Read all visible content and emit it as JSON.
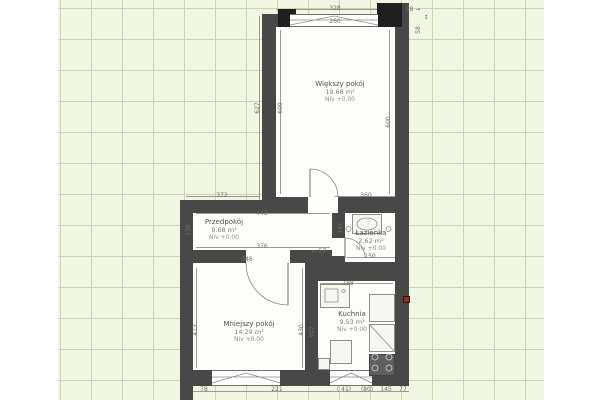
{
  "app": {
    "view": "floor-plan-editor-canvas"
  },
  "palette": {
    "canvas_bg": "#f1f6e3",
    "grid_line": "#ccd5a9",
    "page_margin": "#ffffff",
    "wall": "#484848",
    "corner_block": "#1f1f1f",
    "floor": "#fdfdf9",
    "dimension": "#6f6f6a",
    "marker_red": "#8a3228"
  },
  "rooms": [
    {
      "key": "wiekszy-pokoj",
      "name": "Większy pokój",
      "area": "19.68 m²",
      "level": "Niv +0.00",
      "floor": [
        276,
        27,
        119,
        170
      ],
      "label": [
        340,
        80
      ]
    },
    {
      "key": "przedpokoj",
      "name": "Przedpokój",
      "area": "9.68 m²",
      "level": "Niv +0.00",
      "floor": [
        193,
        213,
        139,
        37
      ],
      "label": [
        224,
        218
      ]
    },
    {
      "key": "lazienka",
      "name": "Łazienka",
      "area": "2.62 m²",
      "level": "Niv +0.00",
      "floor": [
        345,
        213,
        50,
        49
      ],
      "label": [
        371,
        229
      ]
    },
    {
      "key": "mniejszy-pokoj",
      "name": "Mniejszy pokój",
      "area": "14.29 m²",
      "level": "Niv +0.00",
      "floor": [
        193,
        263,
        112,
        107
      ],
      "label": [
        249,
        320
      ]
    },
    {
      "key": "kuchnia",
      "name": "Kuchnia",
      "area": "9.53 m²",
      "level": "Niv +0.00",
      "floor": [
        318,
        281,
        77,
        89
      ],
      "label": [
        352,
        310
      ]
    }
  ],
  "walls": [
    [
      262,
      14,
      147,
      13
    ],
    [
      262,
      14,
      14,
      196
    ],
    [
      395,
      3,
      14,
      383
    ],
    [
      276,
      197,
      119,
      16
    ],
    [
      180,
      200,
      96,
      13
    ],
    [
      180,
      200,
      13,
      200
    ],
    [
      332,
      213,
      13,
      25
    ],
    [
      332,
      256,
      13,
      12
    ],
    [
      318,
      262,
      91,
      19
    ],
    [
      180,
      250,
      152,
      13
    ],
    [
      305,
      263,
      13,
      123
    ],
    [
      180,
      370,
      229,
      16
    ]
  ],
  "corner_blocks": [
    [
      278,
      9,
      18,
      18
    ],
    [
      377,
      3,
      25,
      24
    ]
  ],
  "door_gaps": [
    [
      308,
      197,
      30,
      16
    ],
    [
      246,
      250,
      44,
      13
    ],
    [
      332,
      238,
      13,
      18
    ]
  ],
  "windows": [
    {
      "rect": [
        290,
        14,
        88,
        13
      ],
      "path": "M290,20 L378,20 M290,25 L334,16 L378,25"
    },
    {
      "rect": [
        212,
        370,
        68,
        16
      ],
      "path": "M212,377 L280,377 M212,383 L246,373 L280,383"
    },
    {
      "rect": [
        330,
        370,
        42,
        16
      ],
      "path": "M330,377 L372,377 M330,383 L351,373 L372,383"
    }
  ],
  "doors": [
    {
      "name": "door-wiekszy-pokoj",
      "arc": "M338,197 A28,28 0 0 0 310,169",
      "leaf": "M310,197 L310,169"
    },
    {
      "name": "door-mniejszy-pokoj",
      "arc": "M246,263 A42,42 0 0 0 288,305",
      "leaf": "M288,263 L288,305"
    },
    {
      "name": "door-lazienka",
      "arc": "M345,238 A20,20 0 0 1 365,258",
      "leaf": "M345,258 L345,238"
    }
  ],
  "fixtures": [
    {
      "name": "bath-sink",
      "rect": [
        352,
        214,
        30,
        20
      ],
      "dark": false
    },
    {
      "name": "kitchen-sink",
      "rect": [
        320,
        284,
        30,
        24
      ],
      "dark": false
    },
    {
      "name": "kitchen-counter",
      "rect": [
        369,
        294,
        26,
        28
      ],
      "dark": false
    },
    {
      "name": "kitchen-counter",
      "rect": [
        369,
        324,
        26,
        28
      ],
      "dark": false
    },
    {
      "name": "kitchen-stove",
      "rect": [
        369,
        354,
        26,
        22
      ],
      "dark": true
    },
    {
      "name": "kitchen-cabinet",
      "rect": [
        330,
        340,
        22,
        24
      ],
      "dark": false
    },
    {
      "name": "kitchen-cabinet",
      "rect": [
        318,
        358,
        12,
        12
      ],
      "dark": false
    }
  ],
  "fixture_detail_path": "M357,224 a10,6 0 1 0 20,0 a10,6 0 1 0 -20,0 M325,289 h13 v13 h-13 z M342,291 a1.5,1.5 0 1 0 3,0 a1.5,1.5 0 1 0 -3,0 M369,324 L395,352 M346,229 a2.5,2.5 0 1 0 5,0 a2.5,2.5 0 1 0 -5,0 M386,229 a2.5,2.5 0 1 0 5,0 a2.5,2.5 0 1 0 -5,0",
  "stove_detail_path": "M372,357 a3,3 0 1 0 6,0 a3,3 0 1 0 -6,0 M386,357 a3,3 0 1 0 6,0 a3,3 0 1 0 -6,0 M372,368 a3,3 0 1 0 6,0 a3,3 0 1 0 -6,0 M386,368 a3,3 0 1 0 6,0 a3,3 0 1 0 -6,0",
  "dim_lines": [
    [
      276,
      9,
      119,
      1
    ],
    [
      290,
      22,
      88,
      1
    ],
    [
      186,
      196,
      74,
      1
    ],
    [
      196,
      213,
      134,
      1
    ],
    [
      196,
      247,
      134,
      1
    ],
    [
      210,
      260,
      88,
      1
    ],
    [
      335,
      196,
      62,
      1
    ],
    [
      347,
      257,
      48,
      1
    ],
    [
      320,
      283,
      73,
      1
    ],
    [
      186,
      391,
      223,
      1
    ],
    [
      190,
      215,
      1,
      33
    ],
    [
      280,
      30,
      1,
      164
    ],
    [
      389,
      30,
      1,
      164
    ],
    [
      259,
      16,
      1,
      192
    ],
    [
      341,
      215,
      1,
      42
    ],
    [
      196,
      268,
      1,
      100
    ],
    [
      302,
      268,
      1,
      100
    ],
    [
      313,
      284,
      1,
      84
    ]
  ],
  "dim_labels": [
    {
      "t": "328",
      "x": 335,
      "y": 9,
      "r": 0
    },
    {
      "t": "260",
      "x": 335,
      "y": 22,
      "r": 0
    },
    {
      "t": "58 →",
      "x": 413,
      "y": 10,
      "r": 0
    },
    {
      "t": "58",
      "x": 419,
      "y": 30,
      "r": 1
    },
    {
      "t": "↕",
      "x": 426,
      "y": 18,
      "r": 0
    },
    {
      "t": "627",
      "x": 258,
      "y": 108,
      "r": 1
    },
    {
      "t": "600",
      "x": 281,
      "y": 108,
      "r": 1
    },
    {
      "t": "600",
      "x": 389,
      "y": 122,
      "r": 1
    },
    {
      "t": "372",
      "x": 222,
      "y": 196,
      "r": 0
    },
    {
      "t": "443",
      "x": 262,
      "y": 214,
      "r": 0
    },
    {
      "t": "138",
      "x": 189,
      "y": 230,
      "r": 1
    },
    {
      "t": "376",
      "x": 262,
      "y": 247,
      "r": 0
    },
    {
      "t": "346",
      "x": 247,
      "y": 260,
      "r": 0
    },
    {
      "t": "← 57",
      "x": 319,
      "y": 252,
      "r": 0
    },
    {
      "t": "360",
      "x": 366,
      "y": 196,
      "r": 0
    },
    {
      "t": "141",
      "x": 341,
      "y": 228,
      "r": 1
    },
    {
      "t": "150",
      "x": 370,
      "y": 257,
      "r": 0
    },
    {
      "t": "188",
      "x": 348,
      "y": 284,
      "r": 0
    },
    {
      "t": "507",
      "x": 313,
      "y": 332,
      "r": 1
    },
    {
      "t": "413",
      "x": 196,
      "y": 330,
      "r": 1
    },
    {
      "t": "430",
      "x": 302,
      "y": 330,
      "r": 1
    },
    {
      "t": "78",
      "x": 204,
      "y": 390,
      "r": 0
    },
    {
      "t": "221",
      "x": 277,
      "y": 390,
      "r": 0
    },
    {
      "t": "( 41)",
      "x": 344,
      "y": 390,
      "r": 0
    },
    {
      "t": "(80)",
      "x": 367,
      "y": 390,
      "r": 0
    },
    {
      "t": "145",
      "x": 386,
      "y": 390,
      "r": 0
    },
    {
      "t": "77",
      "x": 403,
      "y": 390,
      "r": 0
    }
  ],
  "marker": {
    "x": 403,
    "y": 296,
    "w": 7,
    "h": 7
  }
}
